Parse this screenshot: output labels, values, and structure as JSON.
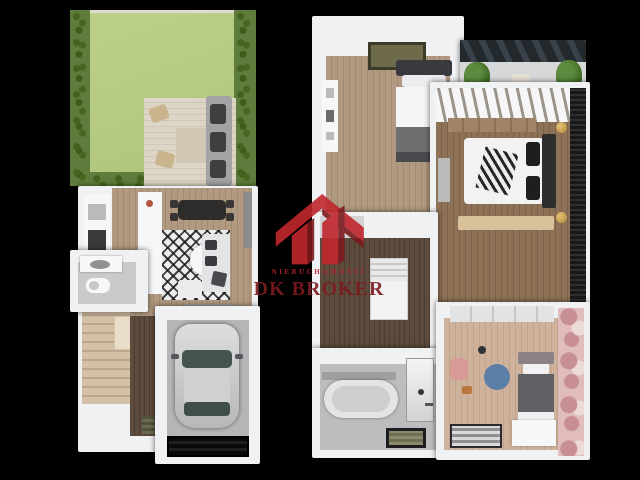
{
  "watermark": {
    "brand_small": "NIERUCHOMOŚCI",
    "brand_large": "DK BROKER",
    "icon": "house-logo-icon",
    "colors": {
      "red": "#c1272d",
      "dark_red": "#7c1a1f",
      "text_dark_red": "#7d1b20"
    }
  },
  "palette": {
    "background": "#000000",
    "walls": "#f0f1f3",
    "lawn": "#b7cb80",
    "hedge": "#5e7c3b",
    "wood_light": "#ab967e",
    "wood_dark": "#5a4a3c",
    "concrete": "#b5b6b8",
    "kids_accent": "#e0bcbc",
    "rug_blue": "#5b7fa6"
  },
  "plans": {
    "left": {
      "name": "ground-floor-plan",
      "areas": [
        "garden",
        "terrace-deck",
        "kitchen",
        "living-room",
        "dining-area",
        "bathroom",
        "staircase",
        "hallway",
        "garage"
      ]
    },
    "right": {
      "name": "upper-floor-plan",
      "areas": [
        "bedroom",
        "balcony",
        "master-bedroom",
        "landing-stairwell",
        "bathroom",
        "kids-room"
      ]
    }
  }
}
